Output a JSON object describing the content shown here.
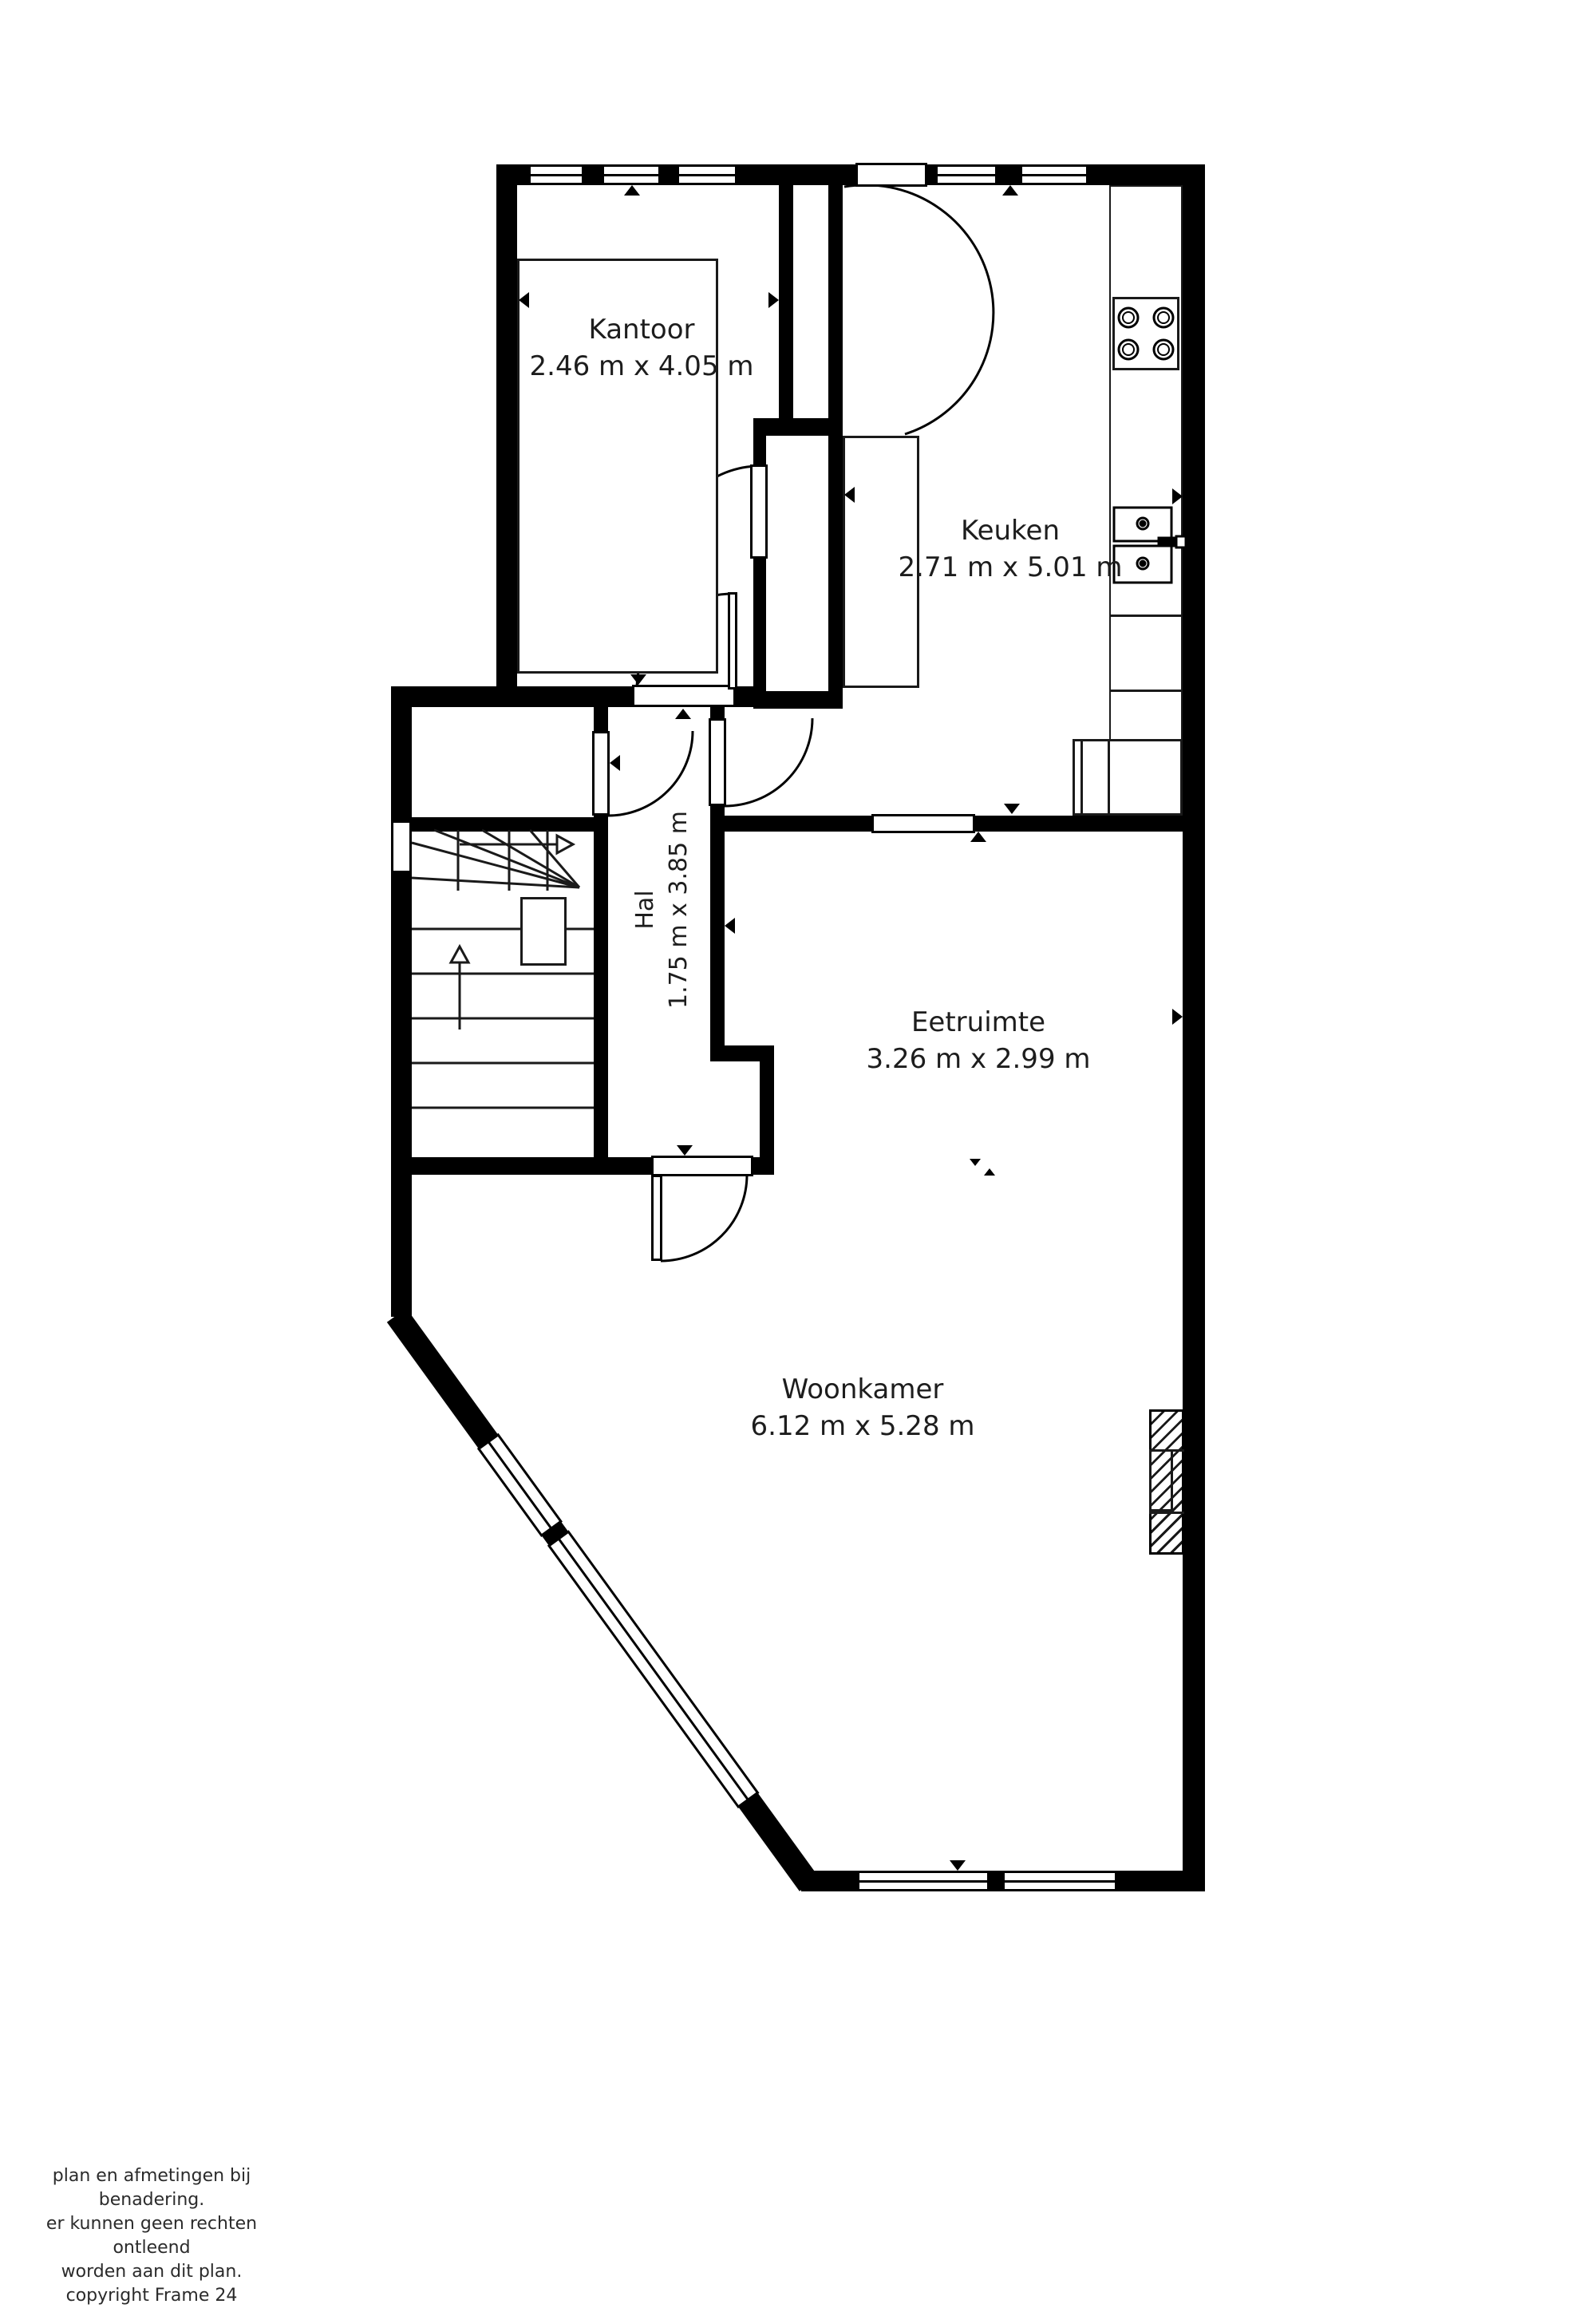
{
  "title": "Begane grond plattegrond",
  "rooms": [
    {
      "id": "kantoor",
      "label": "Kantoor",
      "dims": "2.46 m x 4.05 m"
    },
    {
      "id": "keuken",
      "label": "Keuken",
      "dims": "2.71 m x 5.01 m"
    },
    {
      "id": "hal",
      "label": "Hal",
      "dims": "1.75 m x 3.85 m"
    },
    {
      "id": "eetruimte",
      "label": "Eetruimte",
      "dims": "3.26 m x 2.99 m"
    },
    {
      "id": "woonkamer",
      "label": "Woonkamer",
      "dims": "6.12 m x 5.28 m"
    }
  ],
  "disclaimer": {
    "line1": "plan en afmetingen bij benadering.",
    "line2": "er kunnen geen rechten ontleend",
    "line3": "worden aan dit plan.",
    "line4": "copyright Frame 24"
  },
  "fixtures": [
    "stove-icon",
    "sink-icon",
    "radiator-icon",
    "stairs-icon",
    "desk",
    "kitchen-counter",
    "appliance",
    "stair-table"
  ],
  "colors": {
    "wall": "#000000",
    "background": "#ffffff",
    "text": "#1d1d1d"
  }
}
